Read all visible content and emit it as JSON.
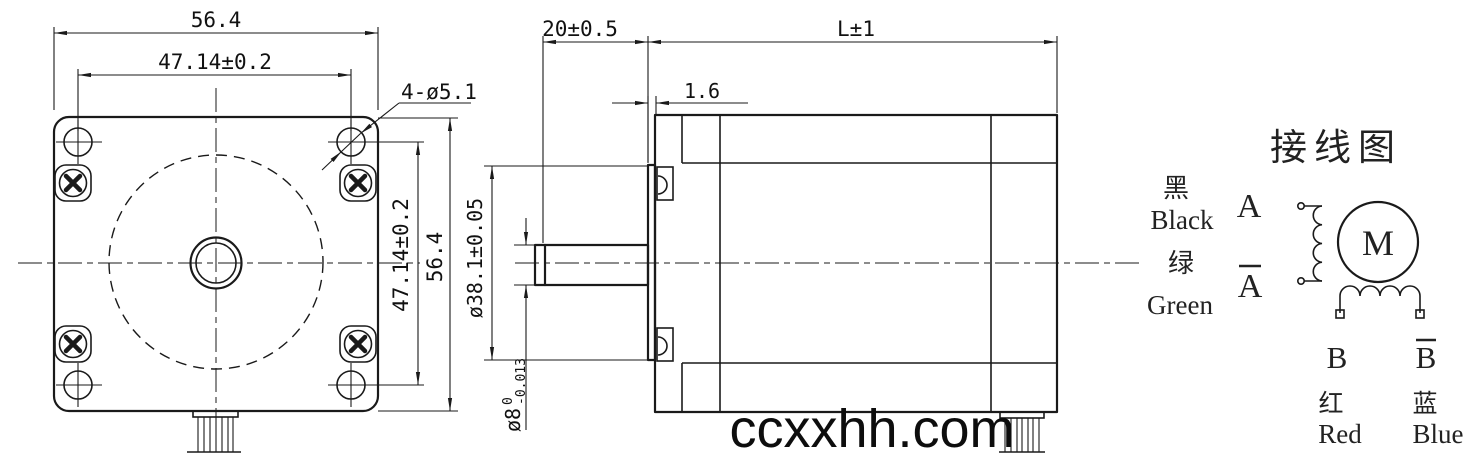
{
  "watermark": {
    "text": "ccxxhh.com"
  },
  "front_view": {
    "dim_width_outer": "56.4",
    "dim_width_holes": "47.14±0.2",
    "holes_callout": "4-ø5.1",
    "dim_height_holes": "47.14±0.2",
    "dim_height_outer": "56.4"
  },
  "side_view": {
    "dim_shaft_ext": "20±0.5",
    "dim_body_len": "L±1",
    "dim_boss_thk": "1.6",
    "dim_boss_dia": "ø38.1±0.05",
    "dim_shaft_dia": "ø8",
    "shaft_tol_upper": "0",
    "shaft_tol_lower": "-0.013"
  },
  "wiring_diagram": {
    "title": "接线图",
    "lead_black_cn": "黑",
    "lead_black_en": "Black",
    "terminal_a": "A",
    "lead_green_cn": "绿",
    "lead_green_en": "Green",
    "terminal_a_bar": "A",
    "motor_symbol": "M",
    "terminal_b": "B",
    "terminal_b_bar": "B",
    "lead_red_cn": "红",
    "lead_red_en": "Red",
    "lead_blue_cn": "蓝",
    "lead_blue_en": "Blue"
  }
}
